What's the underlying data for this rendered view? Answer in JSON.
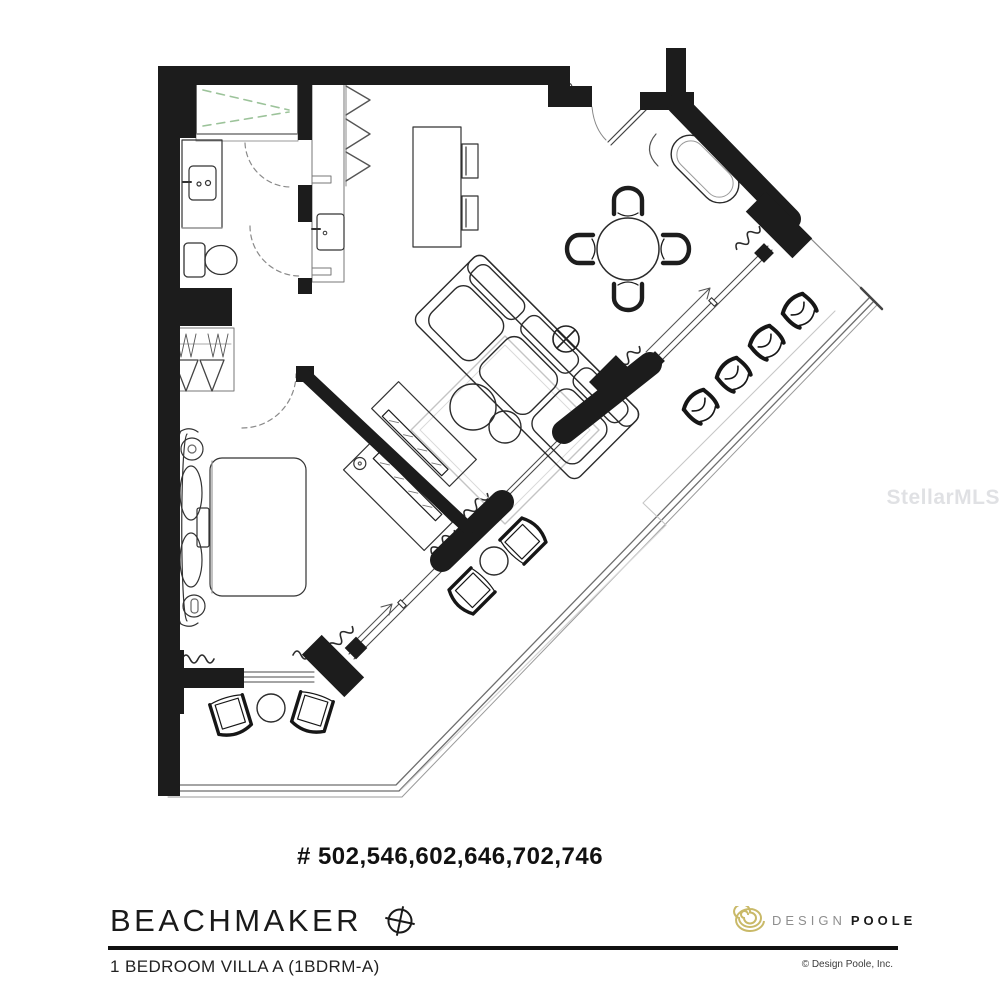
{
  "header": {
    "unit_numbers": "# 502,546,602,646,702,746"
  },
  "title_block": {
    "building_name": "BEACHMAKER",
    "unit_type_label": "1 BEDROOM VILLA A (1BDRM-A)"
  },
  "branding": {
    "design": "DESIGN",
    "poole": "POOLE",
    "copyright": "© Design Poole, Inc."
  },
  "watermark": {
    "text": "StellarMLS"
  },
  "colors": {
    "wall": "#1c1c1c",
    "furniture_line": "#2b2b2b",
    "light_line": "#bdbdbd",
    "shower_glass_green": "#9cc39a",
    "logo_gold": "#c9b968",
    "logo_gray": "#8e8e8e"
  }
}
